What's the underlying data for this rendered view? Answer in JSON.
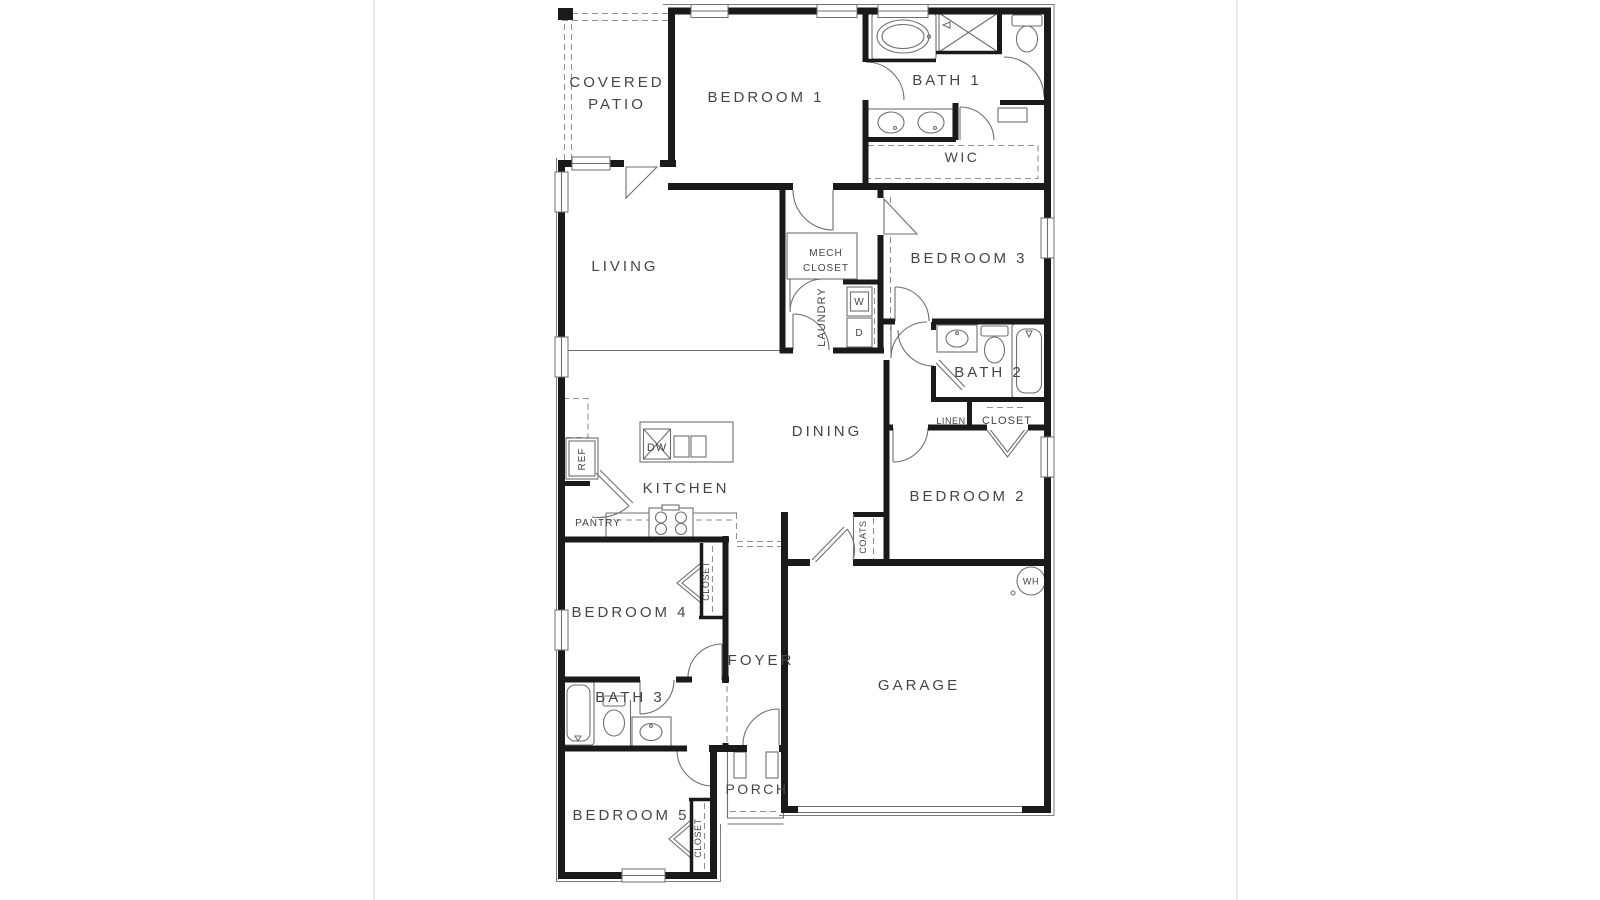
{
  "page": {
    "type": "floor-plan-diagram",
    "background": "#ffffff",
    "palette": {
      "wall": "#1a1a1a",
      "thin_line": "#6f6f6f",
      "dashed_line": "#8f8f8f",
      "text": "#454545",
      "page_divider": "#e4e4e4"
    }
  },
  "plan": {
    "labels": {
      "covered_patio_1": "COVERED",
      "covered_patio_2": "PATIO",
      "bedroom1": "BEDROOM 1",
      "bath1": "BATH 1",
      "wic": "WIC",
      "living": "LIVING",
      "mech_1": "MECH",
      "mech_2": "CLOSET",
      "laundry": "LAUNDRY",
      "washer": "W",
      "dryer": "D",
      "bedroom3": "BEDROOM 3",
      "bath2": "BATH 2",
      "linen": "LINEN",
      "hall_closet": "CLOSET",
      "dining": "DINING",
      "kitchen": "KITCHEN",
      "ref": "REF",
      "pantry": "PANTRY",
      "dishwasher": "DW",
      "bedroom2": "BEDROOM 2",
      "coats": "COATS",
      "water_heater": "WH",
      "garage": "GARAGE",
      "bedroom4": "BEDROOM 4",
      "closet_bed4": "CLOSET",
      "foyer": "FOYER",
      "bath3": "BATH 3",
      "bedroom5": "BEDROOM 5",
      "closet_bed5": "CLOSET",
      "porch": "PORCH"
    }
  }
}
